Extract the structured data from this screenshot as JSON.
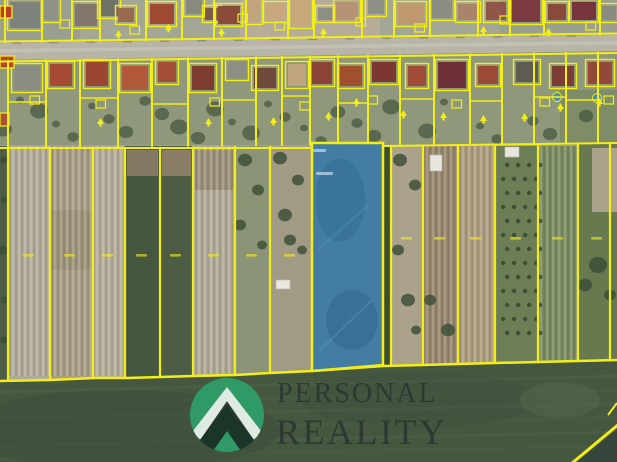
{
  "map": {
    "kind": "aerial-cadastral-photo",
    "colors": {
      "parcel_boundary_yellow": "#f3ee18",
      "highlighted_parcel_blue": "#3277a8",
      "road_gray": "#b8b4a8",
      "field_green": "#45573f"
    },
    "highlighted_parcel": {
      "highlighted": true
    }
  },
  "watermark": {
    "line1": "PERSONAL",
    "line2": "REALITY",
    "logo_green": "#2e9e68",
    "logo_dark": "#1b2a22",
    "text_color": "#2c3531"
  }
}
